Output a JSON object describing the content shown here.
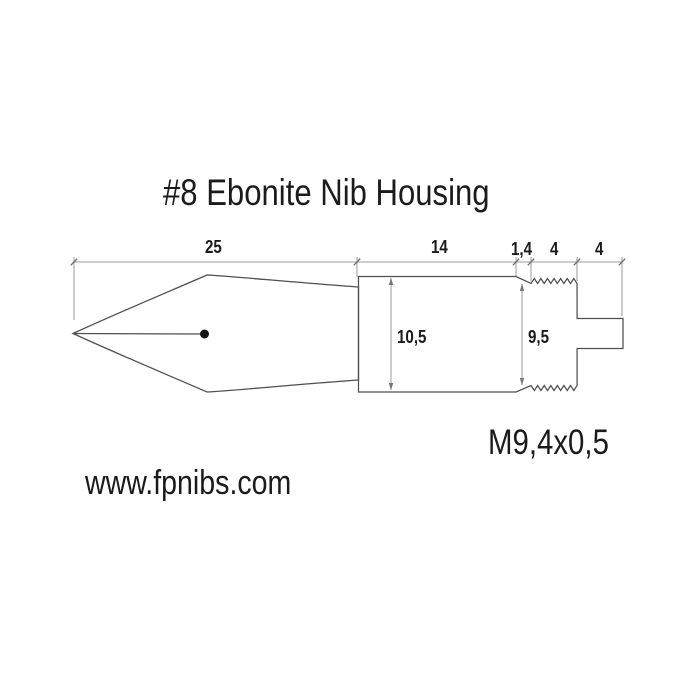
{
  "title": "#8 Ebonite Nib Housing",
  "colors": {
    "background": "#ffffff",
    "text": "#1b1b1b",
    "part_outline": "#4f4f4f",
    "dimension_lines": "#9b9b9b"
  },
  "dimensions": {
    "nib_length": "25",
    "body_length": "14",
    "chamfer_length": "1,4",
    "thread_length": "4",
    "tip_length": "4",
    "body_diameter": "10,5",
    "thread_diameter": "9,5"
  },
  "thread_spec": "M9,4x0,5",
  "website": "www.fpnibs.com"
}
